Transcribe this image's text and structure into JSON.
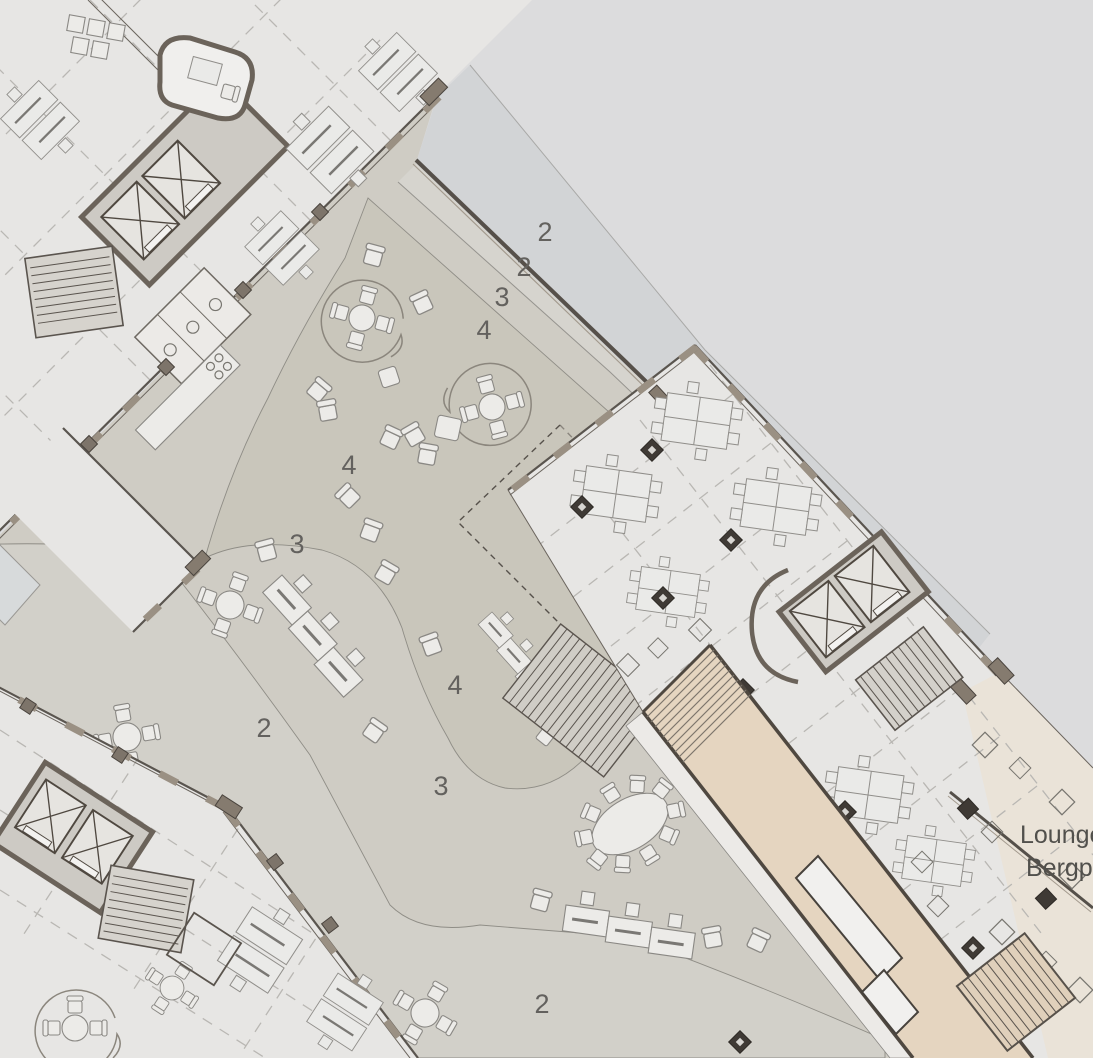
{
  "plan": {
    "type": "architectural-floor-plan",
    "zone_markers": [
      {
        "text": "2",
        "x": 545,
        "y": 241
      },
      {
        "text": "2",
        "x": 524,
        "y": 276
      },
      {
        "text": "3",
        "x": 502,
        "y": 306
      },
      {
        "text": "4",
        "x": 484,
        "y": 339
      },
      {
        "text": "4",
        "x": 349,
        "y": 474
      },
      {
        "text": "3",
        "x": 297,
        "y": 553
      },
      {
        "text": "4",
        "x": 455,
        "y": 694
      },
      {
        "text": "2",
        "x": 264,
        "y": 737
      },
      {
        "text": "3",
        "x": 441,
        "y": 795
      },
      {
        "text": "2",
        "x": 542,
        "y": 1013
      }
    ],
    "lounge_label": {
      "line1": "Lounge",
      "line2": "Bergpf"
    },
    "palette": {
      "background": "#dcdcdd",
      "path_band": "#d2d4d6",
      "courtyard": "#cfccc4",
      "courtyard_light": "#d3d1ca",
      "garden": "#c9c6bb",
      "building_floor": "#e7e6e4",
      "wall": "#56504a",
      "wall_blocks": "#9a9083",
      "ramp": "#e5d5c0",
      "terrace": "#eae3d8",
      "label_gray": "#63615e"
    }
  }
}
